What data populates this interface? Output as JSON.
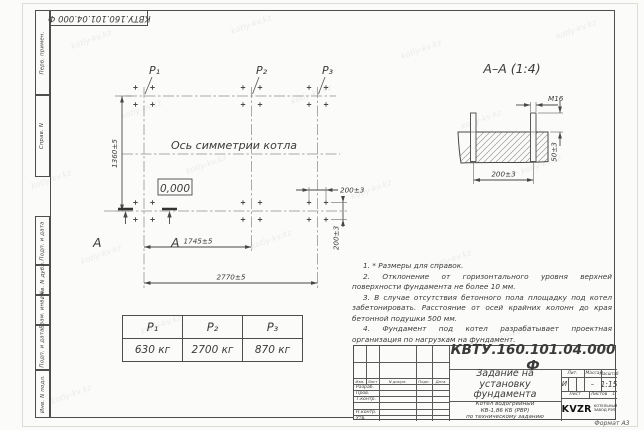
{
  "sheet": {
    "stamp_number_flipped": "КВТУ.160.101.04.000 Ф",
    "format_label": "Формат А3",
    "margin_labels": [
      "Перв. примен.",
      "Справ. N",
      "Подп. и дата",
      "Инв. N дубл.",
      "Взам. инв. N",
      "Подп. и дата",
      "Инв. N подл."
    ]
  },
  "watermark": {
    "text": "kotly-kv.kz"
  },
  "plan": {
    "p_labels": [
      "P₁",
      "P₂",
      "P₃"
    ],
    "symmetry_axis_label": "Ось симметрии котла",
    "level_mark": "0,000",
    "section_letter": "А",
    "dim_height": "1360±5",
    "dim_span_inner": "1745±5",
    "dim_span_total": "2770±5",
    "dim_bolt_spacing_x": "200±3",
    "dim_bolt_spacing_y": "200±3"
  },
  "section": {
    "title": "А–А (1:4)",
    "dim_thread": "М16",
    "dim_protrusion": "50±3",
    "dim_bolt_spacing": "200±3"
  },
  "notes": [
    "1. * Размеры для справок.",
    "2. Отклонение от горизонтального уровня верхней поверхности фундамента не более 10 мм.",
    "3. В случае отсутствия бетонного пола площадку под котел забетонировать. Расстояние от осей крайних колонн до края бетонной подушки 500 мм.",
    "4. Фундамент под котел разрабатывает проектная организация по нагрузкам на фундамент."
  ],
  "load_table": {
    "headers": [
      "P₁",
      "P₂",
      "P₃"
    ],
    "values": [
      "630 кг",
      "2700 кг",
      "870 кг"
    ]
  },
  "title_block": {
    "doc_number": "КВТУ.160.101.04.000 Ф",
    "title_lines": [
      "Задание на",
      "установку",
      "фундамента"
    ],
    "product_lines": [
      "Котел водогрейный",
      "КВ-1,86 КБ (РВР)",
      "по техническому заданию"
    ],
    "header_cells": {
      "izm": "Изм.",
      "list": "Лист",
      "doc": "N докум.",
      "sign": "Подп.",
      "date": "Дата"
    },
    "sign_rows": [
      "Разраб.",
      "Пров.",
      "Т.контр.",
      "Н.контр.",
      "Утв."
    ],
    "lit_label": "Лит.",
    "mass_label": "Масса",
    "scale_label": "Масштаб",
    "lit_value": "И",
    "mass_value": "–",
    "scale_value": "1:15",
    "sheet_label": "Лист",
    "sheets_label": "Листов",
    "sheets_value": "1",
    "company": {
      "logo": "KVZR",
      "name_lines": [
        "КОТЕЛЬНЫЙ",
        "ЗАВОД РЭП"
      ]
    }
  }
}
